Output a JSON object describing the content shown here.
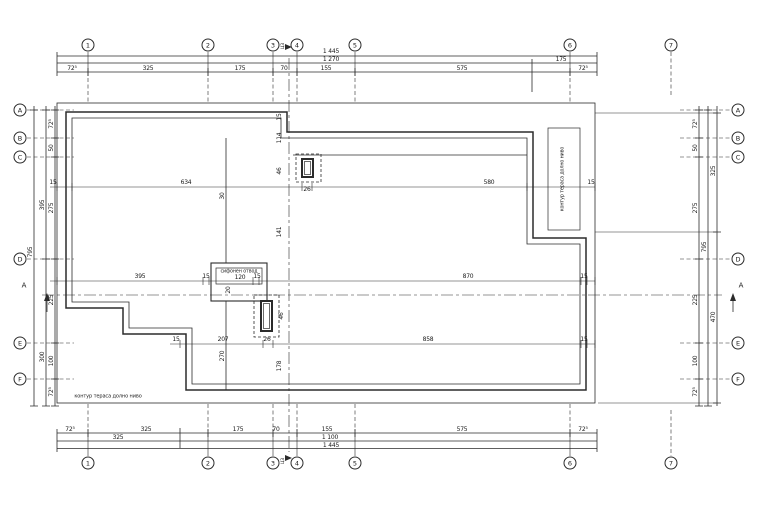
{
  "palette": {
    "line": "#2b2b2b",
    "background": "#ffffff",
    "text": "#1a1a1a"
  },
  "axes": {
    "columns": {
      "labels": [
        "1",
        "2",
        "3",
        "4",
        "5",
        "6",
        "7"
      ],
      "x": [
        88,
        208,
        273,
        297,
        355,
        570,
        671
      ],
      "bubble_y_top": 45,
      "bubble_y_bottom": 463
    },
    "rows": {
      "labels": [
        "A",
        "B",
        "C",
        "D",
        "E",
        "F"
      ],
      "y": [
        110,
        138,
        157,
        259,
        343,
        379
      ],
      "bubble_x_left": 20,
      "bubble_x_right": 738
    },
    "center_axis_label": "ЦЗ",
    "section_label": "A"
  },
  "dimensions_summary": {
    "top": {
      "total": "1 445",
      "row2": [
        "1 270",
        "175"
      ],
      "segments": [
        "72⁵",
        "325",
        "175",
        "70",
        "155",
        "575",
        "72⁵"
      ]
    },
    "bottom": {
      "segments": [
        "72⁵",
        "325",
        "175",
        "70",
        "155",
        "575",
        "72⁵"
      ],
      "row2": [
        "325",
        "1 100"
      ],
      "total": "1 445"
    },
    "left": {
      "segments": [
        "72⁵",
        "50",
        "275",
        "225",
        "100",
        "72⁵"
      ],
      "intermediate": [
        "395",
        "300"
      ],
      "total": "795"
    },
    "right": {
      "segments": [
        "72⁵",
        "50",
        "275",
        "225",
        "100",
        "72⁵"
      ],
      "intermediate": [
        "325",
        "470"
      ],
      "total": "795"
    },
    "interior_horizontal": [
      [
        "15",
        "634",
        "26",
        "580",
        "15"
      ],
      [
        "395",
        "15",
        "120",
        "15",
        "870",
        "15"
      ],
      [
        "15",
        "207",
        "26",
        "858",
        "15"
      ]
    ],
    "interior_vertical": [
      "15",
      "114",
      "46",
      "141",
      "46",
      "178"
    ],
    "interior_misc": [
      "30",
      "20",
      "270",
      "26",
      "26"
    ]
  },
  "dim_labels": {
    "top": [
      {
        "t": "1 445",
        "x": 331,
        "y": 52
      },
      {
        "t": "1 270",
        "x": 331,
        "y": 59.5
      },
      {
        "t": "175",
        "x": 561,
        "y": 59.5
      },
      {
        "t": "72⁵",
        "x": 72,
        "y": 68.5
      },
      {
        "t": "325",
        "x": 148,
        "y": 68.5
      },
      {
        "t": "175",
        "x": 240,
        "y": 68.5
      },
      {
        "t": "70",
        "x": 284,
        "y": 68.5
      },
      {
        "t": "155",
        "x": 326,
        "y": 68.5
      },
      {
        "t": "575",
        "x": 462,
        "y": 68.5
      },
      {
        "t": "72⁵",
        "x": 583,
        "y": 68.5
      }
    ],
    "bottom": [
      {
        "t": "72⁵",
        "x": 70,
        "y": 429.5
      },
      {
        "t": "325",
        "x": 146,
        "y": 429.5
      },
      {
        "t": "175",
        "x": 238,
        "y": 429.5
      },
      {
        "t": "70",
        "x": 276,
        "y": 429.5
      },
      {
        "t": "155",
        "x": 327,
        "y": 429.5
      },
      {
        "t": "575",
        "x": 462,
        "y": 429.5
      },
      {
        "t": "72⁵",
        "x": 583,
        "y": 429.5
      },
      {
        "t": "325",
        "x": 118,
        "y": 438
      },
      {
        "t": "1 100",
        "x": 330,
        "y": 438
      },
      {
        "t": "1 445",
        "x": 331,
        "y": 445.5
      }
    ],
    "left": [
      {
        "t": "72⁵",
        "x": 52,
        "y": 124,
        "r": 1
      },
      {
        "t": "50",
        "x": 52,
        "y": 148,
        "r": 1
      },
      {
        "t": "275",
        "x": 52,
        "y": 208,
        "r": 1
      },
      {
        "t": "225",
        "x": 52,
        "y": 300,
        "r": 1
      },
      {
        "t": "100",
        "x": 52,
        "y": 361,
        "r": 1
      },
      {
        "t": "72⁵",
        "x": 52,
        "y": 392,
        "r": 1
      },
      {
        "t": "395",
        "x": 43,
        "y": 205,
        "r": 1
      },
      {
        "t": "300",
        "x": 43,
        "y": 357,
        "r": 1
      },
      {
        "t": "795",
        "x": 31,
        "y": 252,
        "r": 1
      }
    ],
    "right": [
      {
        "t": "72⁵",
        "x": 696,
        "y": 124,
        "r": 1
      },
      {
        "t": "50",
        "x": 696,
        "y": 148,
        "r": 1
      },
      {
        "t": "275",
        "x": 696,
        "y": 208,
        "r": 1
      },
      {
        "t": "225",
        "x": 696,
        "y": 300,
        "r": 1
      },
      {
        "t": "100",
        "x": 696,
        "y": 361,
        "r": 1
      },
      {
        "t": "72⁵",
        "x": 696,
        "y": 392,
        "r": 1
      },
      {
        "t": "795",
        "x": 705,
        "y": 247,
        "r": 1
      },
      {
        "t": "325",
        "x": 714,
        "y": 171,
        "r": 1
      },
      {
        "t": "470",
        "x": 714,
        "y": 317,
        "r": 1
      }
    ],
    "interior": [
      {
        "t": "15",
        "x": 53,
        "y": 183
      },
      {
        "t": "634",
        "x": 186,
        "y": 183
      },
      {
        "t": "580",
        "x": 489,
        "y": 183
      },
      {
        "t": "15",
        "x": 591,
        "y": 183
      },
      {
        "t": "26",
        "x": 307,
        "y": 190
      },
      {
        "t": "395",
        "x": 140,
        "y": 277
      },
      {
        "t": "15",
        "x": 206,
        "y": 277
      },
      {
        "t": "120",
        "x": 240,
        "y": 277.5
      },
      {
        "t": "15",
        "x": 257,
        "y": 277
      },
      {
        "t": "870",
        "x": 468,
        "y": 277
      },
      {
        "t": "15",
        "x": 584,
        "y": 277
      },
      {
        "t": "15",
        "x": 176,
        "y": 340
      },
      {
        "t": "207",
        "x": 223,
        "y": 340
      },
      {
        "t": "26",
        "x": 267,
        "y": 340
      },
      {
        "t": "858",
        "x": 428,
        "y": 340
      },
      {
        "t": "15",
        "x": 584,
        "y": 340
      },
      {
        "t": "15",
        "x": 280,
        "y": 117,
        "r": 1
      },
      {
        "t": "114",
        "x": 280,
        "y": 138,
        "r": 1
      },
      {
        "t": "46",
        "x": 280,
        "y": 171,
        "r": 1
      },
      {
        "t": "141",
        "x": 280,
        "y": 232,
        "r": 1
      },
      {
        "t": "46",
        "x": 282,
        "y": 316,
        "r": 1
      },
      {
        "t": "178",
        "x": 280,
        "y": 366,
        "r": 1
      },
      {
        "t": "30",
        "x": 223,
        "y": 196,
        "r": 1
      },
      {
        "t": "270",
        "x": 223,
        "y": 356,
        "r": 1
      },
      {
        "t": "20",
        "x": 229,
        "y": 290,
        "r": 1
      }
    ]
  },
  "annotations": [
    {
      "t": "сифонен отвод",
      "x": 239,
      "y": 273,
      "s": 4.8,
      "n": "drain-label"
    },
    {
      "t": "контур тераса долно ниво",
      "x": 108,
      "y": 396.5,
      "s": 5,
      "n": "terrace-contour-label-bottom"
    },
    {
      "t": "контур тераса долно ниво",
      "x": 563.5,
      "y": 179,
      "r": 1,
      "s": 4.8,
      "n": "terrace-contour-label-right"
    },
    {
      "t": "A",
      "x": 24,
      "y": 286,
      "s": 7,
      "n": "section-marker-label-left"
    },
    {
      "t": "A",
      "x": 741,
      "y": 286,
      "s": 7,
      "n": "section-marker-label-right"
    },
    {
      "t": "ЦЗ",
      "x": 284,
      "y": 46,
      "r": 1,
      "s": 4.5,
      "n": "center-axis-label-top"
    },
    {
      "t": "ЦЗ",
      "x": 284,
      "y": 461,
      "r": 1,
      "s": 4.5,
      "n": "center-axis-label-bottom"
    }
  ]
}
